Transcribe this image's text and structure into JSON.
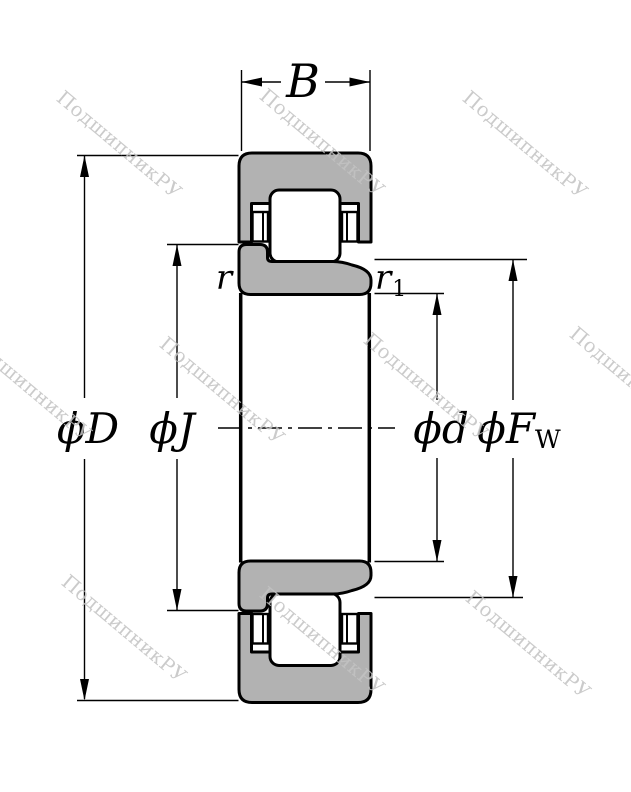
{
  "watermark": {
    "text": "ПодшипникРУ",
    "color": "#c3c3c3"
  },
  "colors": {
    "ring_fill": "#b2b2b2",
    "line": "#000000",
    "background": "#ffffff"
  },
  "dimensions": {
    "width": {
      "label": "B"
    },
    "outer_diameter": {
      "label": "ϕD"
    },
    "rib_diameter": {
      "label": "ϕJ"
    },
    "bore_diameter": {
      "label": "ϕd"
    },
    "raceway_diameter": {
      "label": "ϕF",
      "subscript": "W"
    },
    "chamfer_outer": {
      "label": "r"
    },
    "chamfer_inner": {
      "label": "r",
      "subscript": "1"
    }
  }
}
